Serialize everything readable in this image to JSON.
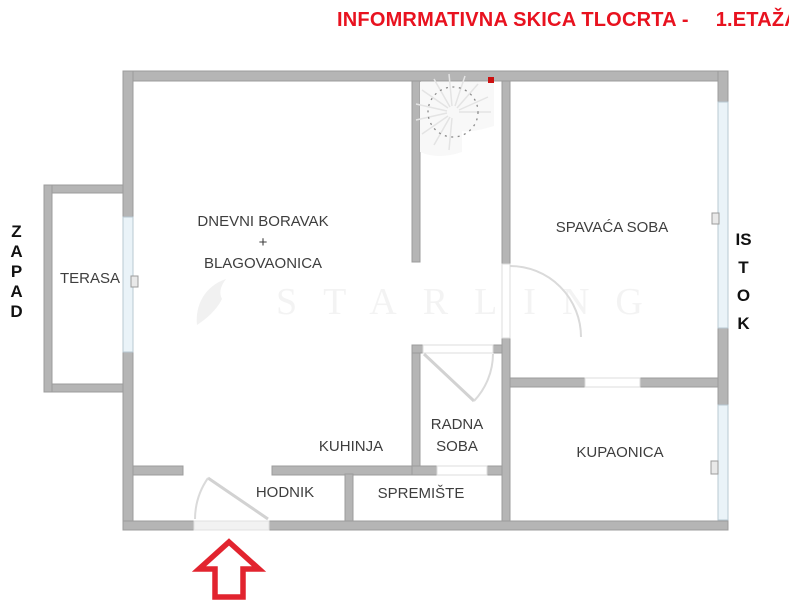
{
  "title": {
    "text": "INFOMRMATIVNA SKICA TLOCRTA -",
    "floor": "1.ETAŽA"
  },
  "compass": {
    "west": "ZAPAD",
    "east": "ISTOK"
  },
  "rooms": {
    "terasa": {
      "label": "TERASA"
    },
    "living": {
      "line1": "DNEVNI BORAVAK",
      "line2": "+",
      "line3": "BLAGOVAONICA"
    },
    "bedroom": {
      "label": "SPAVAĆA SOBA"
    },
    "kitchen": {
      "label": "KUHINJA"
    },
    "study": {
      "label": "RADNA SOBA"
    },
    "bathroom": {
      "label": "KUPAONICA"
    },
    "hallway": {
      "label": "HODNIK"
    },
    "storage": {
      "label": "SPREMIŠTE"
    }
  },
  "watermark": {
    "text": "STARLING"
  },
  "colors": {
    "wall": "#b5b5b5",
    "glass": "#eaf3f8",
    "accent_red": "#e8121f",
    "arrow_red": "#e2242f",
    "label_text": "#3e3e3e"
  }
}
